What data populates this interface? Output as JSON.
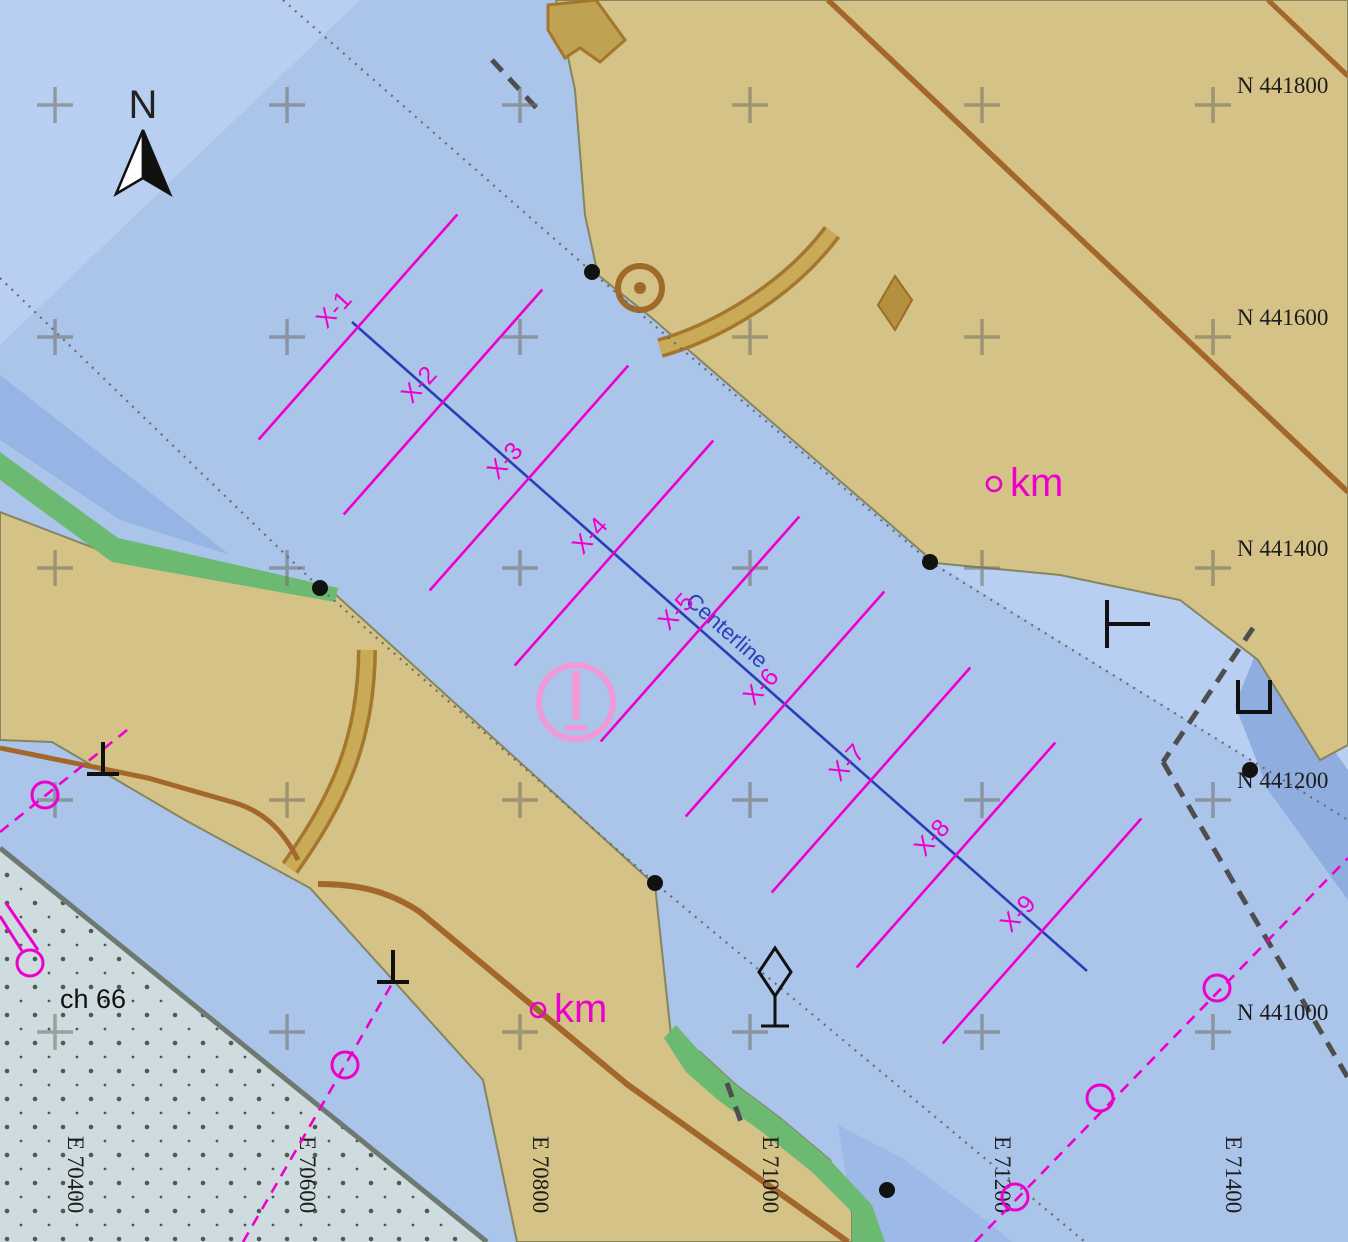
{
  "map": {
    "compass": {
      "north_label": "N"
    },
    "annotations": {
      "centerline_label": "Centerline",
      "channel_label": "ch 66",
      "km_label": "km"
    },
    "grid": {
      "northings": [
        {
          "label": "N 441800",
          "y": 105
        },
        {
          "label": "N 441600",
          "y": 337
        },
        {
          "label": "N 441400",
          "y": 568
        },
        {
          "label": "N 441200",
          "y": 800
        },
        {
          "label": "N 441000",
          "y": 1032
        }
      ],
      "eastings": [
        {
          "label": "E 70400",
          "x": 55
        },
        {
          "label": "E 70600",
          "x": 287
        },
        {
          "label": "E 70800",
          "x": 520
        },
        {
          "label": "E 71000",
          "x": 750
        },
        {
          "label": "E 71200",
          "x": 982
        },
        {
          "label": "E 71400",
          "x": 1213
        }
      ]
    },
    "survey": {
      "stations": [
        {
          "name": "X-1",
          "x": 358,
          "y": 327
        },
        {
          "name": "X-2",
          "x": 443,
          "y": 402
        },
        {
          "name": "X-3",
          "x": 529,
          "y": 478
        },
        {
          "name": "X-4",
          "x": 614,
          "y": 553
        },
        {
          "name": "X-5",
          "x": 700,
          "y": 629
        },
        {
          "name": "X-6",
          "x": 785,
          "y": 704
        },
        {
          "name": "X-7",
          "x": 871,
          "y": 780
        },
        {
          "name": "X-8",
          "x": 956,
          "y": 855
        },
        {
          "name": "X-9",
          "x": 1042,
          "y": 931
        }
      ],
      "line_half_length": 150,
      "centerline": {
        "x1": 352,
        "y1": 322,
        "x2": 1087,
        "y2": 971
      },
      "centerline_label_pos": {
        "x": 722,
        "y": 636,
        "angle": 41.4
      }
    },
    "km_markers": [
      {
        "cx": 994,
        "cy": 484
      },
      {
        "cx": 538,
        "cy": 1010
      }
    ],
    "symbols": {
      "black_dots": [
        [
          592,
          272
        ],
        [
          930,
          562
        ],
        [
          320,
          588
        ],
        [
          655,
          883
        ],
        [
          1250,
          770
        ],
        [
          887,
          1190
        ]
      ],
      "buoy_circles": [
        [
          45,
          795
        ],
        [
          345,
          1065
        ],
        [
          1015,
          1197
        ],
        [
          1100,
          1098
        ],
        [
          1217,
          988
        ]
      ],
      "buoy_dash_lines": [
        [
          0,
          832,
          132,
          726
        ],
        [
          243,
          1242,
          393,
          982
        ],
        [
          975,
          1242,
          1348,
          858
        ]
      ],
      "cable_dashes": [
        [
          492,
          60,
          542,
          114
        ],
        [
          1253,
          628,
          1163,
          762
        ],
        [
          1163,
          762,
          1348,
          1078
        ],
        [
          727,
          1083,
          741,
          1122
        ]
      ],
      "mooring_posts": [
        [
          103,
          742
        ],
        [
          393,
          950
        ]
      ],
      "caution_pos": [
        576,
        702
      ],
      "tank_pos": [
        640,
        288
      ],
      "beacon_pos": [
        775,
        972
      ],
      "corner_buoy_pos": [
        30,
        963
      ]
    },
    "colors": {
      "water": "#abc4ea",
      "water_light": "#b9cff1",
      "water_dark_band": "#96b5e5",
      "basin": "#8fadde",
      "land": "#d4c287",
      "land_edge": "#85855f",
      "road_brown": "#a3672b",
      "road_fill": "#c9aa56",
      "green_shore": "#6cba72",
      "stipple_bg": "#cedbdf",
      "magenta": "#ee00cc",
      "caution_pink": "#f09ad8",
      "centerline_blue": "#2741b5",
      "grid_cross": "#6f6f64",
      "dotted_line": "#6b6b6b",
      "dashed_line": "#4e4e4e",
      "symbol_black": "#111111"
    }
  }
}
